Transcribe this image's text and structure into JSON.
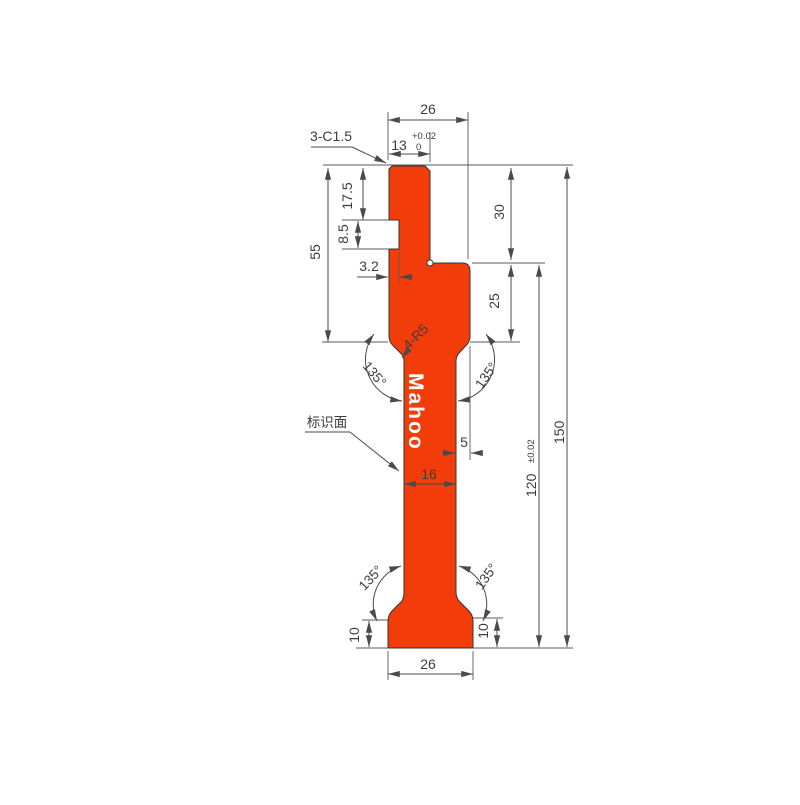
{
  "drawing": {
    "watermark": "Mahoo",
    "labels": {
      "chamfer_note": "3-C1.5",
      "fillet_note": "4-R5",
      "marking_face": "标识面"
    },
    "dimensions": {
      "top_width": "26",
      "tip_width": "13",
      "tip_tol_upper": "+0.02",
      "tip_tol_lower": "0",
      "left_height": "55",
      "shank_length": "17.5",
      "notch_height": "8.5",
      "notch_depth": "3.2",
      "upper_right_height": "30",
      "mid_right_height": "25",
      "side_offset": "5",
      "stem_width": "16",
      "lower_height": "120",
      "lower_height_tol": "±0.02",
      "total_height": "150",
      "angle_top_left": "135°",
      "angle_top_right": "135°",
      "angle_bottom_left": "135°",
      "angle_bottom_right": "135°",
      "base_height_left": "10",
      "base_height_right": "10",
      "base_width": "26"
    },
    "colors": {
      "profile": "#f23c0a",
      "line": "#4a4a4a"
    }
  }
}
